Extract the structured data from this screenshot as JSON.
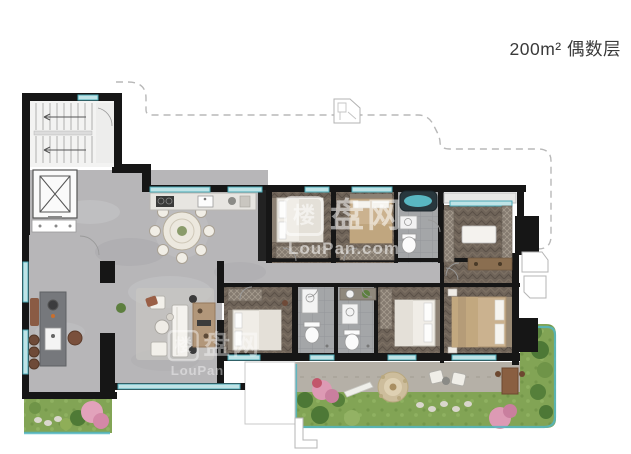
{
  "header": {
    "title": "200m² 偶数层"
  },
  "watermark": {
    "logo_char": "楼",
    "brand_cn": "盘网",
    "brand_en": "LouPan.com"
  },
  "colors": {
    "wall": "#161616",
    "marble_floor": "#b7b6b8",
    "wood_floor": "#6f6459",
    "tile_floor": "#a4a6a8",
    "window_teal": "#4aa9b6",
    "window_fill": "#bfe3e6",
    "grass": "#82a455",
    "terrace": "#b5b0a7",
    "pink_bush": "#dd9ab4",
    "tan_furniture": "#cbb28f",
    "white_furniture": "#f0ede7",
    "dashed_boundary": "#b8b8b8",
    "title_text": "#3a3a3a"
  }
}
